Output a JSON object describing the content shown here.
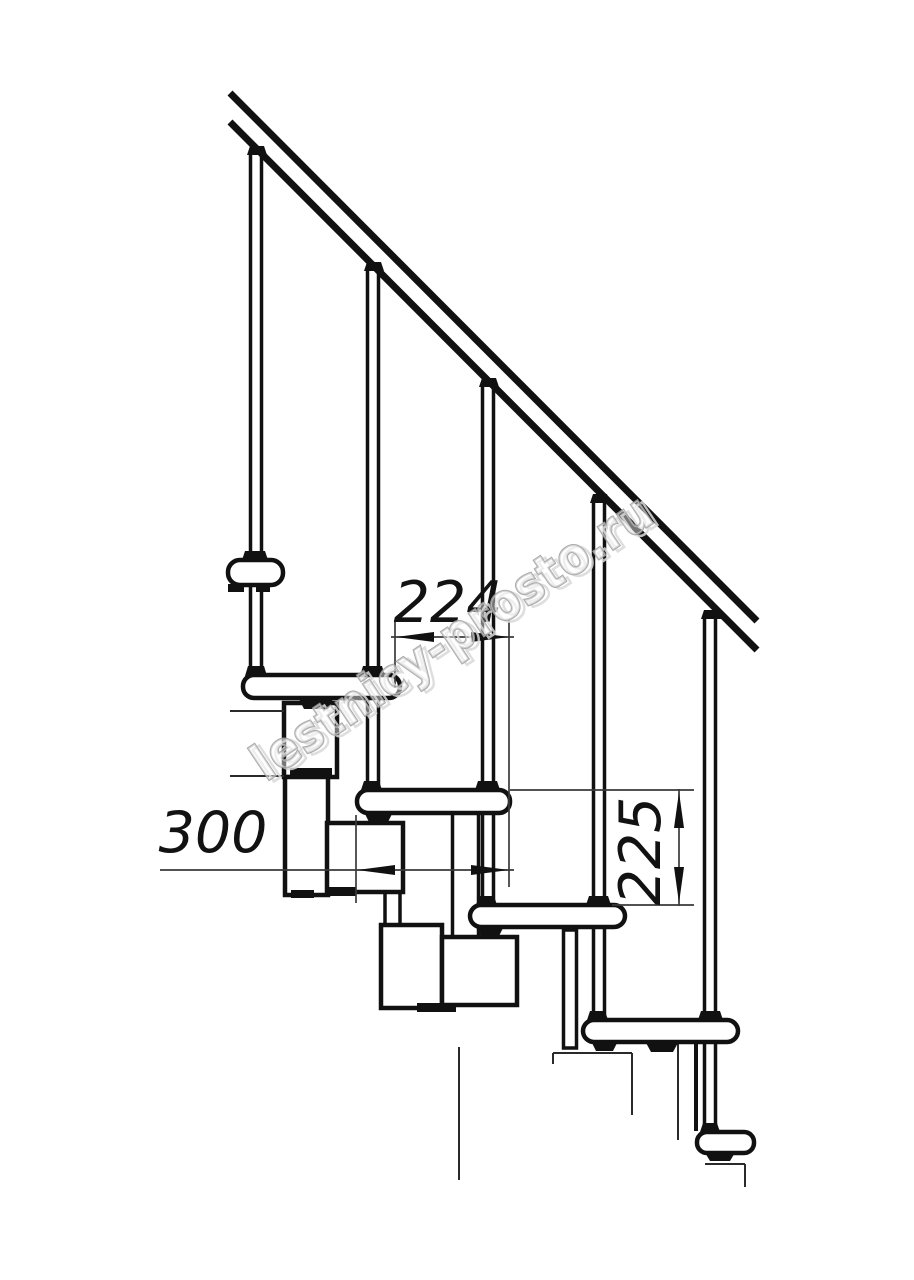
{
  "drawing": {
    "type": "staircase-side-view-technical-drawing",
    "watermark": "lestnicy-prosto.ru",
    "dimensions": {
      "step_going": "224",
      "tread_depth": "300",
      "step_rise": "225"
    },
    "colors": {
      "line": "#111111",
      "thin_line": "#2a2a2a",
      "dimension_line": "#3a3a3a",
      "watermark_stroke": "#9e9e9e",
      "background": "#ffffff"
    }
  }
}
